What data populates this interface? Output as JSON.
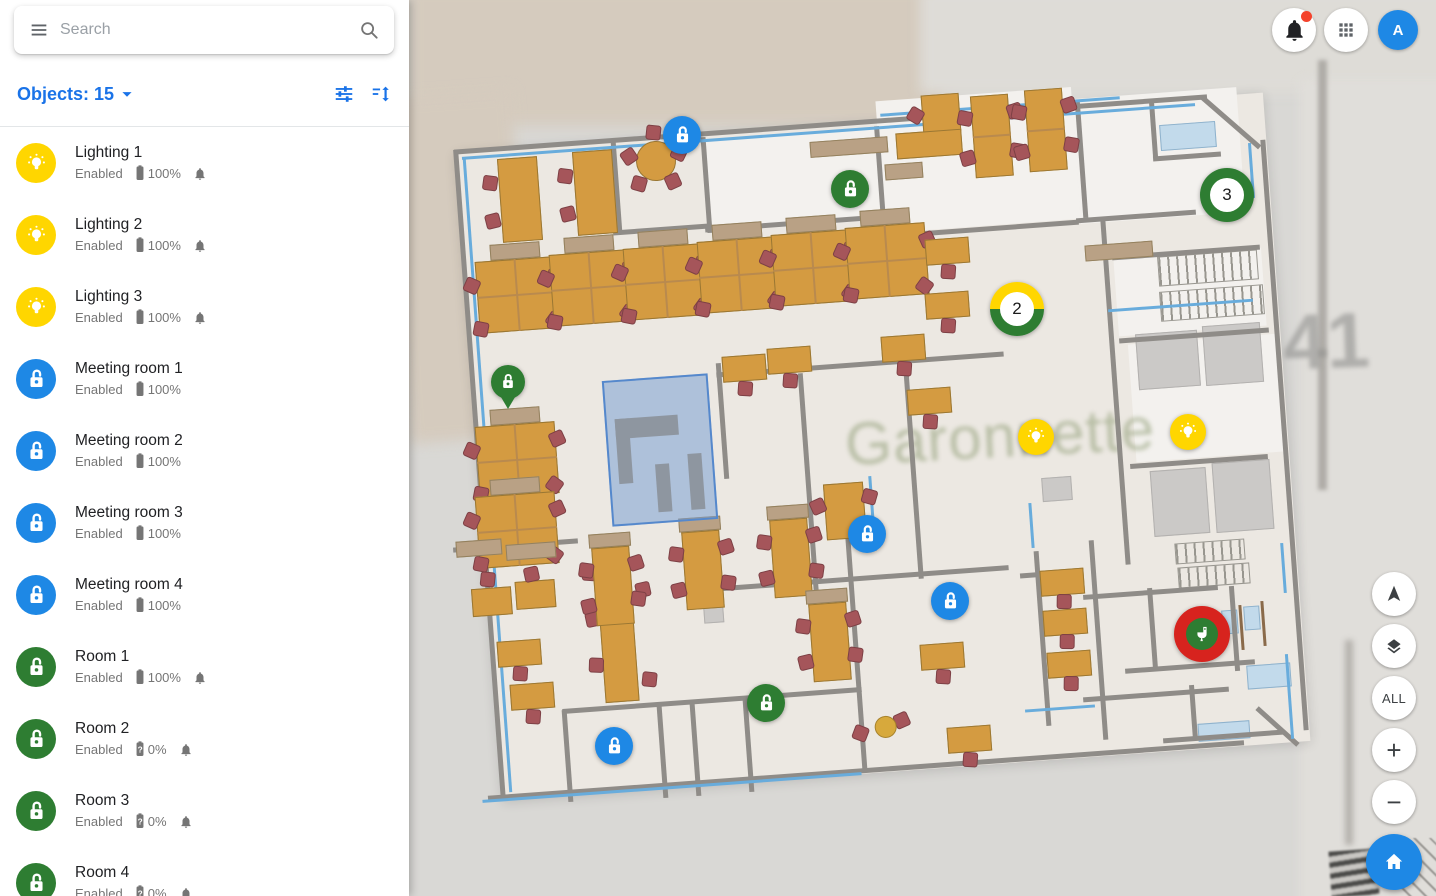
{
  "topbar": {
    "search_placeholder": "Search"
  },
  "account": {
    "initial": "A"
  },
  "sidebar": {
    "title": "Objects: 15",
    "items": [
      {
        "name": "Lighting 1",
        "status": "Enabled",
        "battery": "100%",
        "battery_unknown": false,
        "bell": true,
        "icon": "light",
        "icon_color": "yellow"
      },
      {
        "name": "Lighting 2",
        "status": "Enabled",
        "battery": "100%",
        "battery_unknown": false,
        "bell": true,
        "icon": "light",
        "icon_color": "yellow"
      },
      {
        "name": "Lighting 3",
        "status": "Enabled",
        "battery": "100%",
        "battery_unknown": false,
        "bell": true,
        "icon": "light",
        "icon_color": "yellow"
      },
      {
        "name": "Meeting room 1",
        "status": "Enabled",
        "battery": "100%",
        "battery_unknown": false,
        "bell": false,
        "icon": "lock",
        "icon_color": "blue"
      },
      {
        "name": "Meeting room 2",
        "status": "Enabled",
        "battery": "100%",
        "battery_unknown": false,
        "bell": false,
        "icon": "lock",
        "icon_color": "blue"
      },
      {
        "name": "Meeting room 3",
        "status": "Enabled",
        "battery": "100%",
        "battery_unknown": false,
        "bell": false,
        "icon": "lock",
        "icon_color": "blue"
      },
      {
        "name": "Meeting room 4",
        "status": "Enabled",
        "battery": "100%",
        "battery_unknown": false,
        "bell": false,
        "icon": "lock",
        "icon_color": "blue"
      },
      {
        "name": "Room 1",
        "status": "Enabled",
        "battery": "100%",
        "battery_unknown": false,
        "bell": true,
        "icon": "lock",
        "icon_color": "green"
      },
      {
        "name": "Room 2",
        "status": "Enabled",
        "battery": "0%",
        "battery_unknown": true,
        "bell": true,
        "icon": "lock",
        "icon_color": "green"
      },
      {
        "name": "Room 3",
        "status": "Enabled",
        "battery": "0%",
        "battery_unknown": true,
        "bell": true,
        "icon": "lock",
        "icon_color": "green"
      },
      {
        "name": "Room 4",
        "status": "Enabled",
        "battery": "0%",
        "battery_unknown": true,
        "bell": true,
        "icon": "lock",
        "icon_color": "green"
      }
    ]
  },
  "map": {
    "street_label": "Garonnette",
    "lot_number": "41",
    "all_button": "ALL",
    "markers": [
      {
        "id": "lock-1",
        "type": "lock",
        "shape": "circle",
        "color": "blue",
        "x": 682,
        "y": 135
      },
      {
        "id": "lock-2",
        "type": "lock",
        "shape": "circle",
        "color": "green",
        "x": 850,
        "y": 189
      },
      {
        "id": "cluster-3",
        "type": "cluster",
        "shape": "cluster",
        "label": "3",
        "colors": [
          "green",
          "green"
        ],
        "x": 1227,
        "y": 195
      },
      {
        "id": "cluster-2",
        "type": "cluster",
        "shape": "cluster",
        "label": "2",
        "colors": [
          "yellow",
          "green"
        ],
        "x": 1017,
        "y": 309
      },
      {
        "id": "pin-lock",
        "type": "lock",
        "shape": "pin",
        "color": "green",
        "x": 508,
        "y": 382
      },
      {
        "id": "light-1",
        "type": "light",
        "shape": "bulbc",
        "color": "yellow",
        "x": 1036,
        "y": 437
      },
      {
        "id": "light-2",
        "type": "light",
        "shape": "bulbc",
        "color": "yellow",
        "x": 1188,
        "y": 432
      },
      {
        "id": "lock-3",
        "type": "lock",
        "shape": "circle",
        "color": "blue",
        "x": 867,
        "y": 534
      },
      {
        "id": "lock-4",
        "type": "lock",
        "shape": "circle",
        "color": "blue",
        "x": 950,
        "y": 601
      },
      {
        "id": "toilet-1",
        "type": "toilet",
        "shape": "toilet",
        "color": "red",
        "x": 1202,
        "y": 634
      },
      {
        "id": "lock-5",
        "type": "lock",
        "shape": "circle",
        "color": "green",
        "x": 766,
        "y": 703
      },
      {
        "id": "lock-6",
        "type": "lock",
        "shape": "circle",
        "color": "blue",
        "x": 614,
        "y": 746
      }
    ]
  },
  "palette": {
    "yellow": "#FFD600",
    "blue": "#1E88E5",
    "green": "#2E7D32",
    "red": "#D7231E",
    "accent": "#1A73E8"
  }
}
